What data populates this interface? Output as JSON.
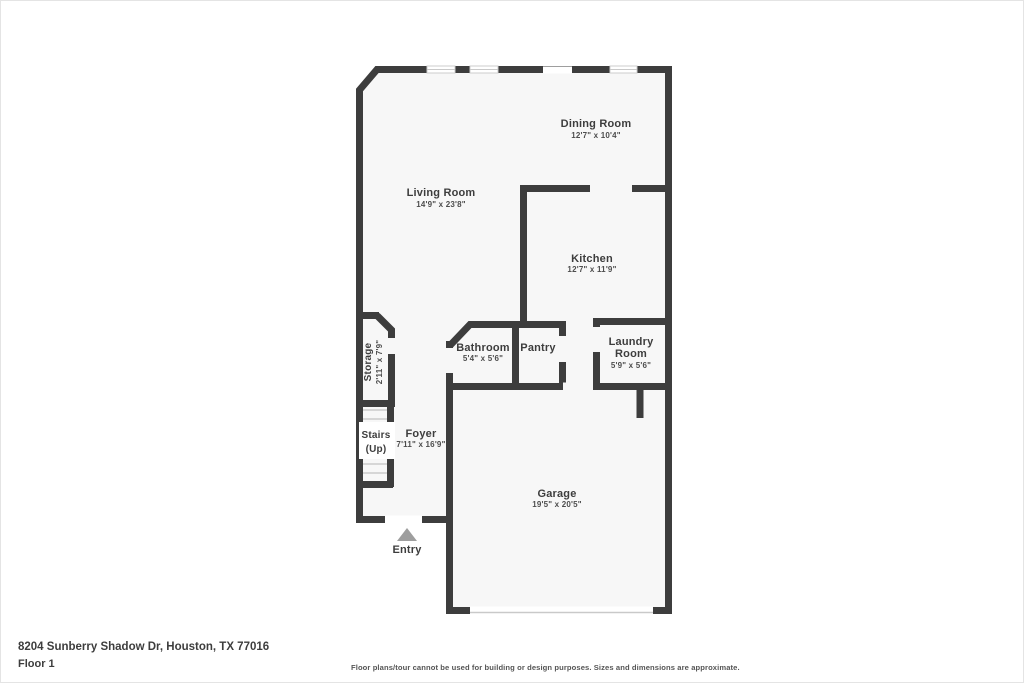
{
  "footer": {
    "address": "8204 Sunberry Shadow Dr, Houston, TX 77016",
    "floor_label": "Floor 1",
    "disclaimer": "Floor plans/tour cannot be used for building or design purposes. Sizes and dimensions are approximate."
  },
  "entry": {
    "label": "Entry"
  },
  "rooms": {
    "dining": {
      "name": "Dining Room",
      "dims": "12'7\" x 10'4\""
    },
    "living": {
      "name": "Living Room",
      "dims": "14'9\" x 23'8\""
    },
    "kitchen": {
      "name": "Kitchen",
      "dims": "12'7\" x 11'9\""
    },
    "bathroom": {
      "name": "Bathroom",
      "dims": "5'4\" x 5'6\""
    },
    "pantry": {
      "name": "Pantry"
    },
    "laundry": {
      "name_line1": "Laundry",
      "name_line2": "Room",
      "dims": "5'9\" x 5'6\""
    },
    "storage": {
      "name": "Storage",
      "dims": "2'11\" x 7'9\""
    },
    "stairs": {
      "name_line1": "Stairs",
      "name_line2": "(Up)"
    },
    "foyer": {
      "name": "Foyer",
      "dims": "7'11\" x 16'9\""
    },
    "garage": {
      "name": "Garage",
      "dims": "19'5\" x 20'5\""
    }
  },
  "colors": {
    "wall": "#3d3d3d",
    "floor": "#f7f7f7",
    "text": "#3d3d3d",
    "entry": "#9e9e9e"
  }
}
